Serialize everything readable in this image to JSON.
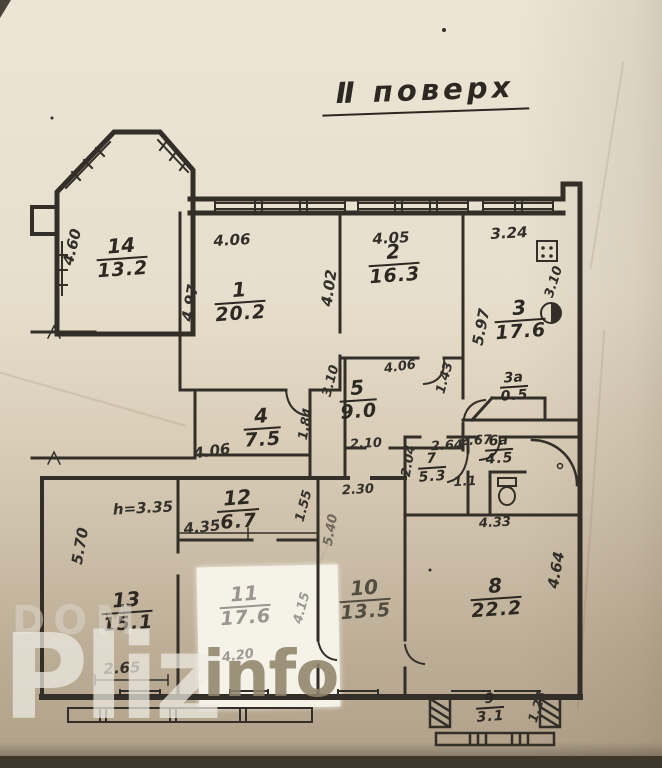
{
  "title": "Ⅱ поверх",
  "colors": {
    "paper_top": "#ece5d5",
    "paper_bottom": "#b0a089",
    "ink": "#2d2922",
    "watermark_light": "#eeebe3",
    "watermark_olive": "#8f846a",
    "white_patch": "#f5f2e8",
    "photo_edge": "#3d372c"
  },
  "watermark": {
    "dom": "DOM",
    "pliz": "Pliz",
    "info": "info"
  },
  "rooms": {
    "r14": {
      "number": "14",
      "area": "13.2"
    },
    "r1": {
      "number": "1",
      "area": "20.2"
    },
    "r2": {
      "number": "2",
      "area": "16.3"
    },
    "r3": {
      "number": "3",
      "area": "17.6"
    },
    "r3a": {
      "number": "3а",
      "area": "0.5"
    },
    "r4": {
      "number": "4",
      "area": "7.5"
    },
    "r5": {
      "number": "5",
      "area": "9.0"
    },
    "r6a": {
      "number": "6а",
      "area": "4.5"
    },
    "r7": {
      "number": "7",
      "area": "5.3"
    },
    "r8": {
      "number": "8",
      "area": "22.2"
    },
    "r9": {
      "number": "9",
      "area": "3.1"
    },
    "r10": {
      "number": "10",
      "area": "13.5"
    },
    "r11": {
      "number": "11",
      "area": "17.6"
    },
    "r12": {
      "number": "12",
      "area": "6.7"
    },
    "r13": {
      "number": "13",
      "area": "15.1"
    },
    "wc": {
      "area": "1.1"
    }
  },
  "dims": {
    "r14_left": "4.60",
    "r1_top": "4.06",
    "r1_left": "4.97",
    "r2_top": "4.05",
    "r2_left": "4.02",
    "r3_top": "3.24",
    "r3_left": "5.97",
    "r3_right": "3.10",
    "r5_left": "3.10",
    "r5_top": "4.06",
    "r5_bottom": "2.10",
    "r4_bottom": "4.06",
    "r4_right": "1.84",
    "hall": "1.43",
    "r7_top": "2.64",
    "r7_left": "2.04",
    "r6a_top": "2.67",
    "bath_bottom": "4.33",
    "r12_height": "h=3.35",
    "r12_width": "4.35",
    "r12_right": "1.55",
    "r13_left": "5.70",
    "r13_bottom": "2.65",
    "r11_right": "4.15",
    "r11_bottom": "4.20",
    "r10_top": "2.30",
    "r10_left": "5.40",
    "r8_right": "4.64",
    "r9_right": "1.23"
  },
  "fixtures": {
    "stove": "stove-icon",
    "sink": "sink-icon",
    "toilet": "toilet-icon",
    "bathtub": "bathtub-icon"
  }
}
